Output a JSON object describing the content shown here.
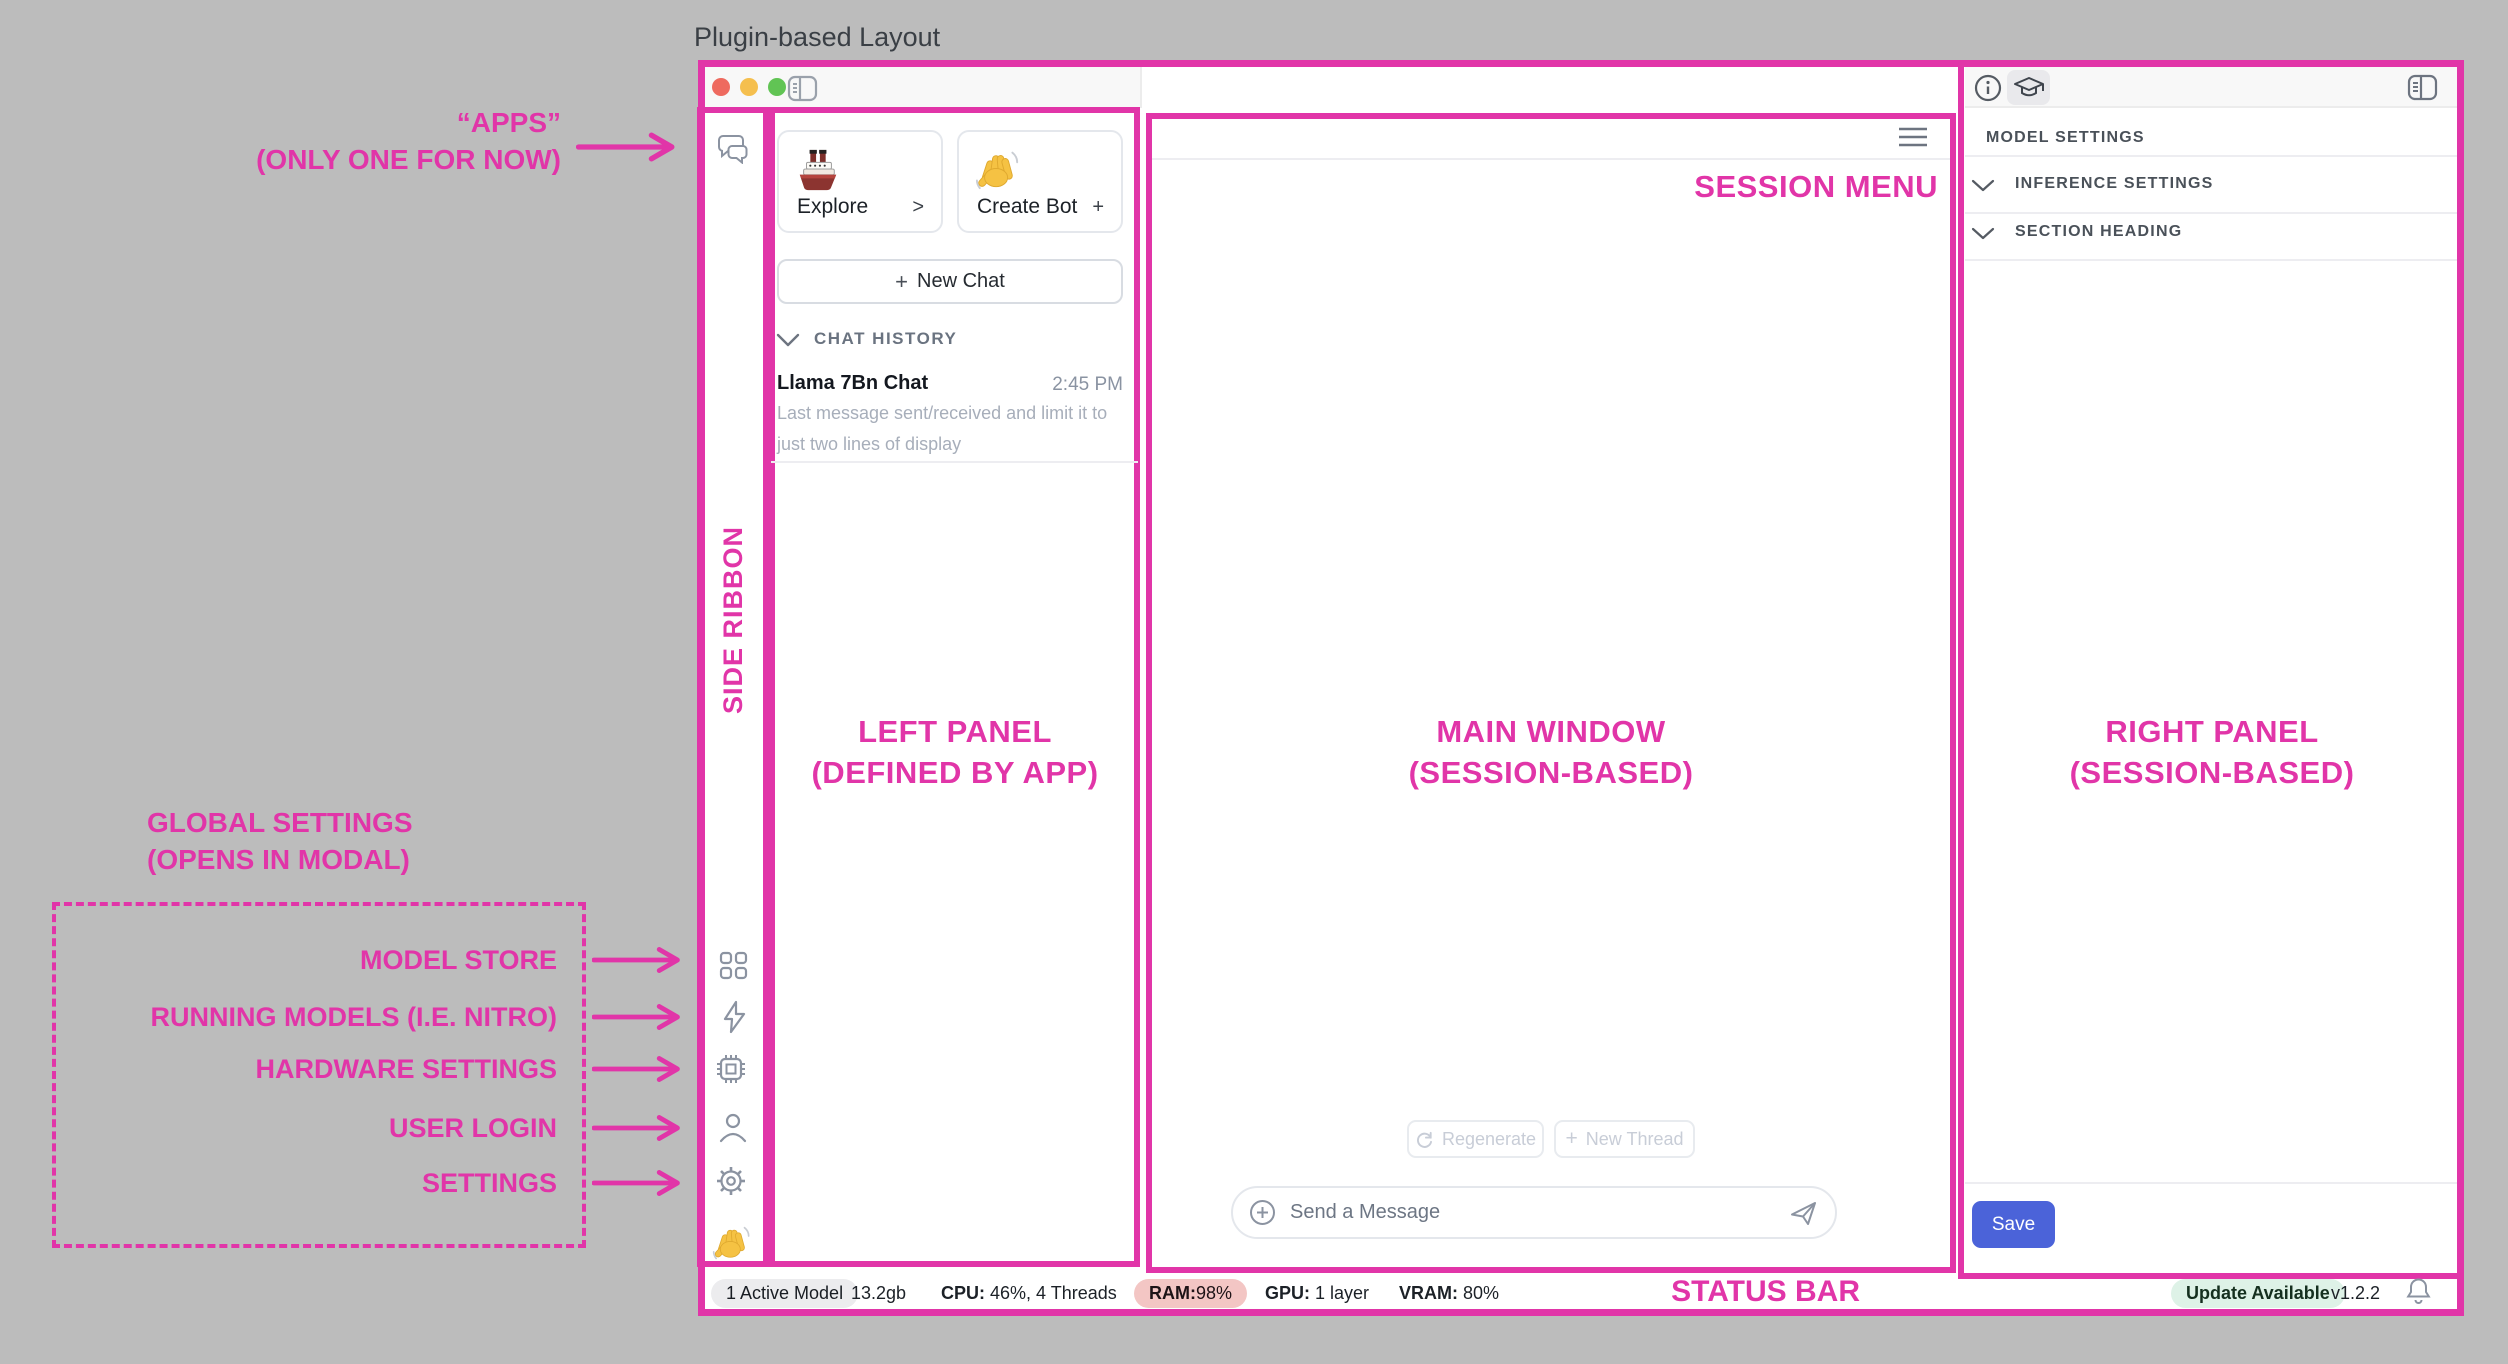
{
  "page": {
    "title": "Plugin-based Layout"
  },
  "annotations": {
    "accent_color": "#e135a8",
    "apps_line1": "“APPS”",
    "apps_line2": "(ONLY ONE FOR NOW)",
    "side_ribbon": "SIDE RIBBON",
    "left_panel_line1": "LEFT PANEL",
    "left_panel_line2": "(DEFINED BY APP)",
    "main_window_line1": "MAIN WINDOW",
    "main_window_line2": "(SESSION-BASED)",
    "right_panel_line1": "RIGHT PANEL",
    "right_panel_line2": "(SESSION-BASED)",
    "session_menu": "SESSION MENU",
    "status_bar": "STATUS BAR",
    "global_settings_line1": "GLOBAL SETTINGS",
    "global_settings_line2": "(OPENS IN MODAL)",
    "model_store": "MODEL STORE",
    "running_models": "RUNNING MODELS (I.E. NITRO)",
    "hardware_settings": "HARDWARE SETTINGS",
    "user_login": "USER LOGIN",
    "settings": "SETTINGS"
  },
  "left_panel": {
    "explore_card": {
      "label": "Explore",
      "chevron": ">"
    },
    "create_bot_card": {
      "label": "Create Bot",
      "plus": "+"
    },
    "new_chat_button": {
      "plus": "+",
      "label": "New Chat"
    },
    "chat_history_header": "CHAT HISTORY",
    "chat_item": {
      "title": "Llama 7Bn Chat",
      "time": "2:45 PM",
      "preview": "Last message sent/received and limit it to just two lines of display"
    }
  },
  "main_window": {
    "regenerate_button": "Regenerate",
    "new_thread_button": {
      "plus": "+",
      "label": "New Thread"
    },
    "message_input_placeholder": "Send a Message"
  },
  "right_panel": {
    "model_settings_header": "MODEL SETTINGS",
    "sections": [
      {
        "label": "INFERENCE SETTINGS"
      },
      {
        "label": "SECTION HEADING"
      }
    ],
    "save_button": "Save"
  },
  "status_bar": {
    "active_models": "1 Active Model",
    "memory": "13.2gb",
    "cpu_label": "CPU:",
    "cpu_value": " 46%, 4 Threads",
    "ram_label": "RAM:",
    "ram_value": " 98%",
    "gpu_label": "GPU:",
    "gpu_value": " 1 layer",
    "vram_label": "VRAM:",
    "vram_value": " 80%",
    "update_badge": "Update Available",
    "version": "v1.2.2"
  }
}
